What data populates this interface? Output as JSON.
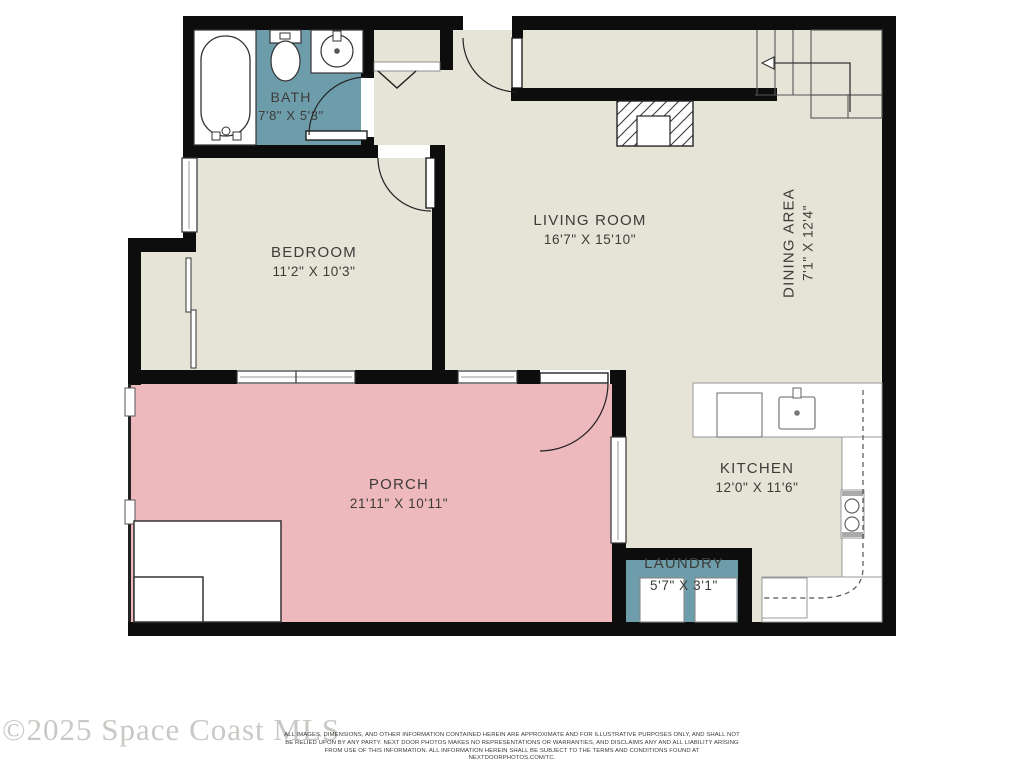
{
  "colors": {
    "floor_beige": "#e6e4d7",
    "wet_room_teal": "#6d9cab",
    "porch_pink": "#eeb9bd",
    "wall_black": "#0d0d0d"
  },
  "rooms": [
    {
      "key": "bath",
      "name": "BATH",
      "dims": "7'8\" X 5'3\""
    },
    {
      "key": "bedroom",
      "name": "BEDROOM",
      "dims": "11'2\" X 10'3\""
    },
    {
      "key": "living-room",
      "name": "LIVING ROOM",
      "dims": "16'7\" X 15'10\""
    },
    {
      "key": "dining-area",
      "name": "DINING AREA",
      "dims": "7'1\" X 12'4\""
    },
    {
      "key": "porch",
      "name": "PORCH",
      "dims": "21'11\" X 10'11\""
    },
    {
      "key": "kitchen",
      "name": "KITCHEN",
      "dims": "12'0\" X 11'6\""
    },
    {
      "key": "laundry",
      "name": "LAUNDRY",
      "dims": "5'7\" X 3'1\""
    }
  ],
  "watermark": "©2025 Space Coast MLS",
  "disclaimer": "ALL IMAGES, DIMENSIONS, AND OTHER INFORMATION CONTAINED HEREIN ARE APPROXIMATE AND FOR ILLUSTRATIVE PURPOSES ONLY, AND SHALL NOT BE RELIED UPON BY ANY PARTY. NEXT DOOR PHOTOS MAKES NO REPRESENTATIONS OR WARRANTIES, AND DISCLAIMS ANY AND ALL LIABILITY ARISING FROM USE OF THIS INFORMATION. ALL INFORMATION HEREIN SHALL BE SUBJECT TO THE TERMS AND CONDITIONS FOUND AT NEXTDOORPHOTOS.COM/TC."
}
